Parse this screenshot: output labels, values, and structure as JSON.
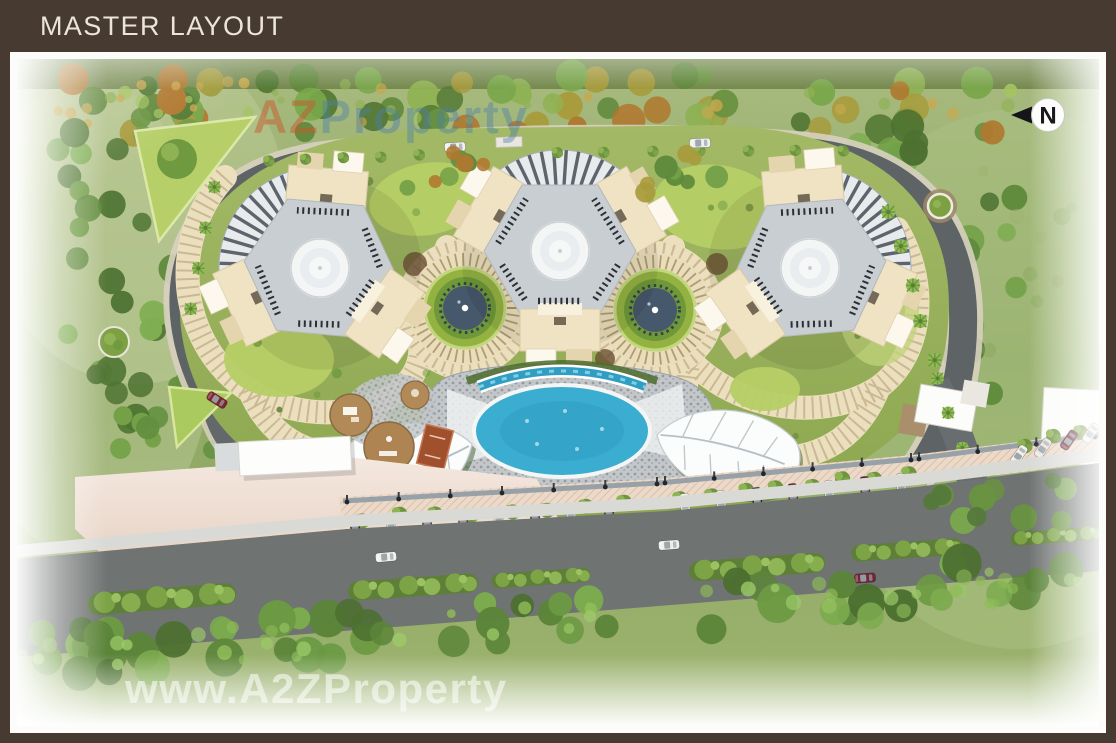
{
  "header": {
    "title": "MASTER LAYOUT"
  },
  "plan": {
    "north_label": "N",
    "watermark_top": {
      "part1": "AZ",
      "part2": "Property"
    },
    "watermark_bottom": "www.A2ZProperty",
    "palette": {
      "frame_brown": "#473b31",
      "mat_white": "#fcfcfa",
      "landscape_green": "#93ab61",
      "lawn_bright": "#b7cf66",
      "ring_road_grey": "#5e6365",
      "main_road_grey": "#6f7371",
      "path_cream": "#ecdfbd",
      "building_cream": "#efe3c3",
      "tower_grey": "#c9ced2",
      "pool_blue": "#3aadd0",
      "deck_grey": "#c3c7ca",
      "plaza_pink": "#eedcd3"
    }
  }
}
